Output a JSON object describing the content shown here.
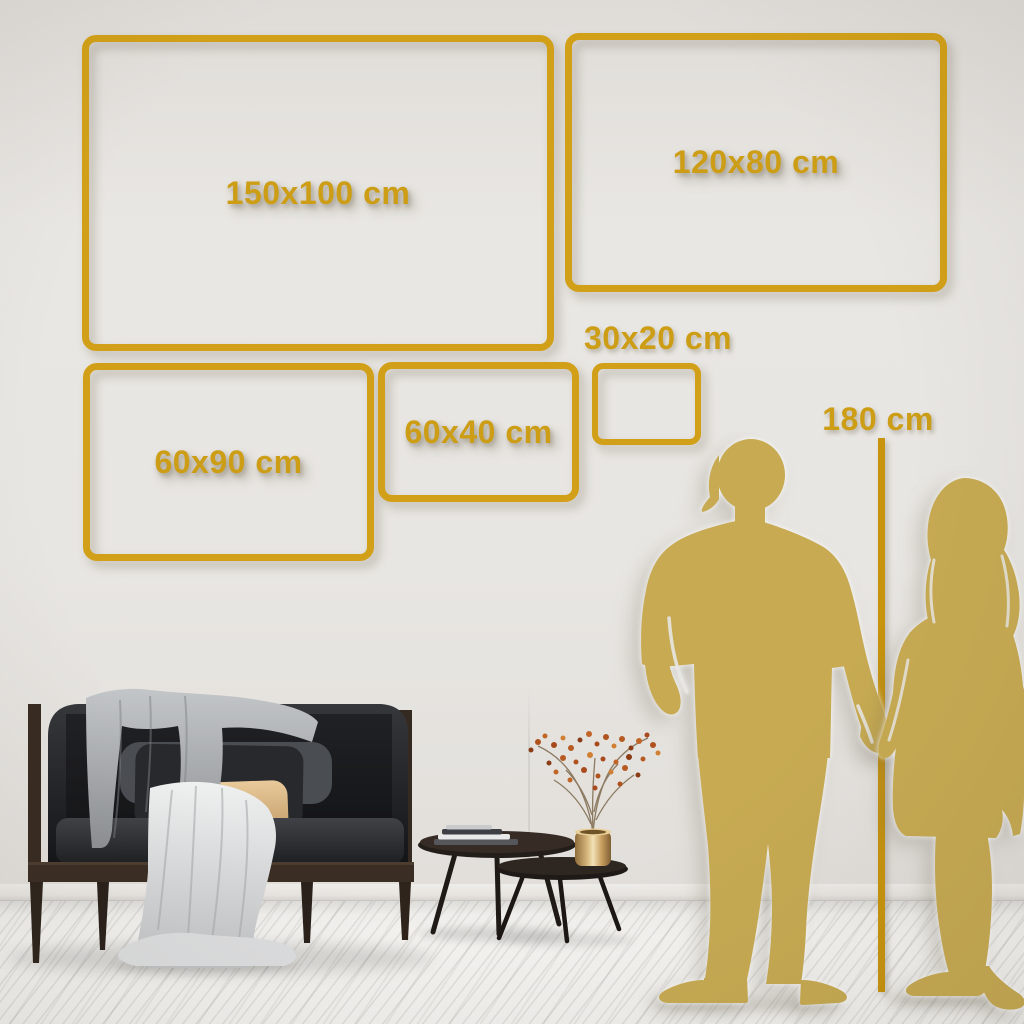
{
  "size_guide": {
    "frames": [
      {
        "label": "150x100 cm",
        "width_cm": 150,
        "height_cm": 100
      },
      {
        "label": "120x80 cm",
        "width_cm": 120,
        "height_cm": 80
      },
      {
        "label": "60x90 cm",
        "width_cm": 60,
        "height_cm": 90
      },
      {
        "label": "60x40 cm",
        "width_cm": 60,
        "height_cm": 40
      },
      {
        "label": "30x20 cm",
        "width_cm": 30,
        "height_cm": 20
      }
    ],
    "height_reference": {
      "label": "180 cm",
      "height_cm": 180
    }
  },
  "colors": {
    "frame_gold": "#D2A018",
    "label_gold": "#CC9D15",
    "ruler_gold": "#C8940E",
    "silhouette_gold": "#C7AA52",
    "wall": "#E8E6E2",
    "floor": "#F3F2EF"
  }
}
